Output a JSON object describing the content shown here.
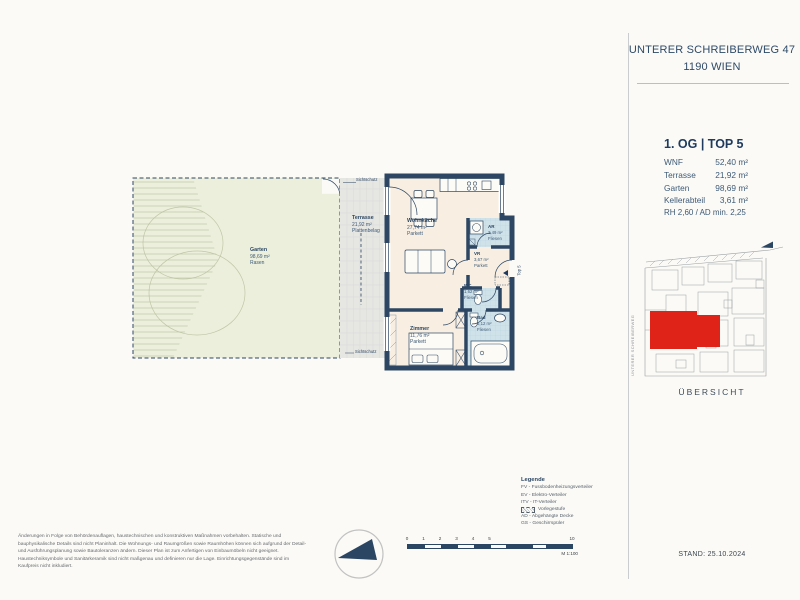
{
  "colors": {
    "navy": "#2c4663",
    "text_navy": "#1e3a5e",
    "red": "#e02318",
    "cream": "#f8efe2",
    "tile_blue": "#cfe2ea",
    "garden_green": "#ecefdc",
    "terrace_grey": "#e6e6e3"
  },
  "sidebar": {
    "address_line1": "UNTERER SCHREIBERWEG 47",
    "address_line2": "1190 WIEN",
    "unit_title": "1. OG | TOP 5",
    "stats": [
      {
        "label": "WNF",
        "value": "52,40 m²"
      },
      {
        "label": "Terrasse",
        "value": "21,92 m²"
      },
      {
        "label": "Garten",
        "value": "98,69 m²"
      },
      {
        "label": "Kellerabteil",
        "value": "3,61 m²"
      }
    ],
    "height_note": "RH 2,60 / AD min. 2,25",
    "street_label": "UNTERER SCHREIBERWEG",
    "overview_label": "ÜBERSICHT",
    "stand": "STAND: 25.10.2024"
  },
  "plan": {
    "rooms": [
      {
        "name": "Garten",
        "area": "98,69 m²",
        "floor": "Rasen"
      },
      {
        "name": "Terrasse",
        "area": "21,92 m²",
        "floor": "Plattenbelag"
      },
      {
        "name": "Wohnküche",
        "area": "27,74 m²",
        "floor": "Parkett"
      },
      {
        "name": "AR",
        "area": "2,49 m²",
        "floor": "Fliesen"
      },
      {
        "name": "VR",
        "area": "3,67 m²",
        "floor": "Parkett"
      },
      {
        "name": "WC",
        "area": "1,62 m²",
        "floor": "Fliesen"
      },
      {
        "name": "Zimmer",
        "area": "11,76 m²",
        "floor": "Parkett"
      },
      {
        "name": "Bad",
        "area": "5,12 m²",
        "floor": "Fliesen"
      }
    ],
    "sichtschutz_top": "Sichtschutz",
    "sichtschutz_bottom": "Sichtschutz",
    "entry_label": "Top 5"
  },
  "legend": {
    "title": "Legende",
    "items": [
      "FV - Fussbodenheizungsverteiler",
      "EV - Elektro-Verteiler",
      "ITV - IT-Verteiler",
      "Vorlegestufe",
      "AD - Abgehängte Decke",
      "GS - Geschirrspüler"
    ]
  },
  "scalebar": {
    "ticks": [
      "0",
      "1",
      "2",
      "3",
      "4",
      "5",
      "10"
    ],
    "scale_label": "M 1:100"
  },
  "disclaimer": "Änderungen in Folge von Behördenauflagen, haustechnischen und konstruktiven Maßnahmen vorbehalten. Statische und bauphysikalische Details sind nicht Planinhalt. Die Wohnungs- und Raumgrößen sowie Raumhöhen können sich aufgrund der Detail- und Ausführungsplanung sowie Bautoleranzen ändern. Dieser Plan ist zum Anfertigen von Einbaumöbeln nicht geeignet. Haustechniksymbole und Sanitärkeramik sind nicht maßgenau und definieren nur die Lage. Einrichtungsgegenstände sind im Kaufpreis nicht inkludiert."
}
